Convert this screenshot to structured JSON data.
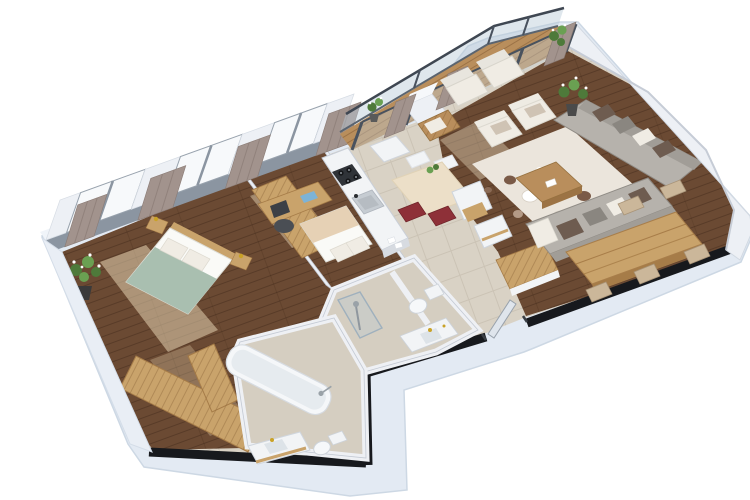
{
  "scene": {
    "type": "3d-floor-plan-render",
    "description": "Isometric 3D render of an apartment floor plan on a white background, rotated diagonally, with black exterior wall caps, window wall with curtains at the top-left, a glazed balcony at the top, and an angled white wall on the right.",
    "background": "#ffffff"
  },
  "palette": {
    "background": "#ffffff",
    "outer_band": "#e3eaf3",
    "outer_edge": "#cdd8e4",
    "wall_face": "#edf0f5",
    "wall_shade": "#c9d0da",
    "wall_black": "#17191d",
    "window_frame": "#8b95a1",
    "glass": "#f7f9fb",
    "curtain": "#a2938d",
    "curtain_fold": "#8a7b75",
    "tile": "#d9d2c5",
    "wood_dark": "#6b4a33",
    "wood_light": "#c9a36b",
    "wood_deck": "#b98e5c",
    "rug": "#ebe5dc",
    "sofa_gray": "#b6b2ac",
    "sofa_shadow": "#a19d97",
    "cushion_white": "#f0ece4",
    "cushion_gray": "#8a8680",
    "cushion_brown": "#6e5c50",
    "furn_white": "#f2f4f6",
    "bed_green": "#a9bfb0",
    "bed_beige": "#e6d1b5",
    "chair_red": "#8e3038",
    "gold": "#c9a227",
    "chrome": "#9aa2a8",
    "plant_green": "#4e7a3a",
    "plant_light": "#6aa052",
    "table_beige": "#ecdfc8"
  },
  "rooms": [
    {
      "id": "master-bedroom",
      "floor": "dark-wood"
    },
    {
      "id": "second-bedroom",
      "floor": "dark-wood"
    },
    {
      "id": "kitchen",
      "floor": "tile"
    },
    {
      "id": "dining-area",
      "floor": "tile"
    },
    {
      "id": "living-room",
      "floor": "dark-wood"
    },
    {
      "id": "balcony",
      "floor": "wood-deck"
    },
    {
      "id": "hallway-entry",
      "floor": "tile"
    },
    {
      "id": "bathroom-shower",
      "floor": "tile"
    },
    {
      "id": "bathroom-tub",
      "floor": "tile"
    }
  ],
  "furniture": {
    "master_bedroom": [
      "double-bed-sage-blanket",
      "white-pillows",
      "nightstands-with-lamps",
      "tall-oak-wardrobe",
      "potted-plant-white-flowers"
    ],
    "second_bedroom": [
      "single-bed-beige-blanket",
      "desk",
      "office-chair",
      "laptop"
    ],
    "kitchen": [
      "counter-with-gas-hob",
      "sink",
      "tall-white-cabinet"
    ],
    "dining_area": [
      "table",
      "chairs-red-cushions",
      "white-chairs",
      "storage-cubes-oak-insert",
      "oak-slat-bench"
    ],
    "living_room": [
      "two-white-armchairs",
      "wood-coffee-table",
      "area-rug-with-circles",
      "l-shaped-gray-sofa",
      "throw-pillows",
      "large-plank-dining-table",
      "side-chairs",
      "potted-plants"
    ],
    "balcony": [
      "glass-railing",
      "sliding-glass-doors",
      "curtains",
      "two-white-loungers",
      "wood-slat-daybed",
      "small-plant"
    ],
    "bathroom_shower": [
      "glass-shower",
      "toilet",
      "washbasin-counter-gold-fittings"
    ],
    "bathroom_tub": [
      "bathtub",
      "vanity-sink-gold-faucet",
      "toilet"
    ],
    "hallway": [
      "entry-door-ajar",
      "built-in-oak-wardrobe"
    ]
  }
}
